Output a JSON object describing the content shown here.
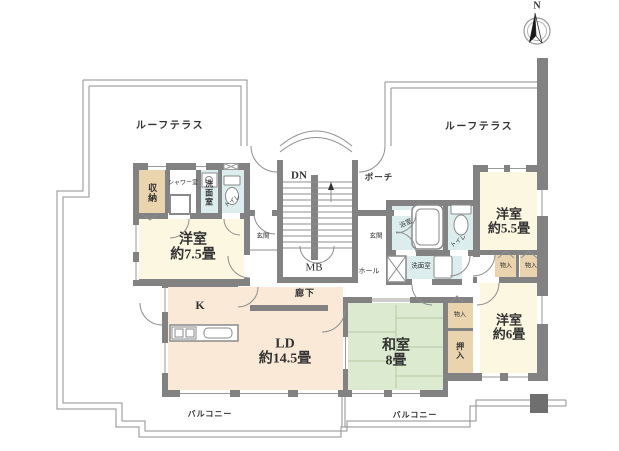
{
  "compass": {
    "north_label": "N"
  },
  "outdoor": {
    "roof_terrace_left": "ルーフテラス",
    "roof_terrace_right": "ルーフテラス",
    "porch": "ポーチ",
    "balcony_left": "バルコニー",
    "balcony_right": "バルコニー"
  },
  "circulation": {
    "stairs_down": "DN",
    "meter_box": "MB",
    "entrance_left": "玄関",
    "entrance_right": "玄関",
    "hall": "ホール",
    "corridor": "廊下"
  },
  "rooms": {
    "western_7_5": {
      "name": "洋室",
      "size": "約7.5畳"
    },
    "western_5_5": {
      "name": "洋室",
      "size": "約5.5畳"
    },
    "western_6": {
      "name": "洋室",
      "size": "約6畳"
    },
    "japanese_8": {
      "name": "和室",
      "size": "8畳"
    },
    "living_dining": {
      "name": "LD",
      "size": "約14.5畳"
    },
    "kitchen": {
      "name": "K"
    },
    "closet": "収納",
    "shower_room": "シャワー室",
    "washroom_left": "洗面室",
    "toilet_left": "トイレ",
    "bathroom": "浴室",
    "washroom_right": "洗面室",
    "toilet_right": "トイレ",
    "storage_1": "物入",
    "storage_2": "物入",
    "storage_3": "物入",
    "futon_closet": "押入"
  },
  "colors": {
    "wall": "#828282",
    "line": "#8f8f8f",
    "room-yellow": "#fbf7e1",
    "room-peach": "#f9e9d6",
    "room-green": "#dcead0",
    "room-tan": "#e9d4ad",
    "room-cyan": "#dcedee",
    "tatami-line": "#b3cba0",
    "pillar": "#6f6f6f",
    "text": "#333333"
  }
}
